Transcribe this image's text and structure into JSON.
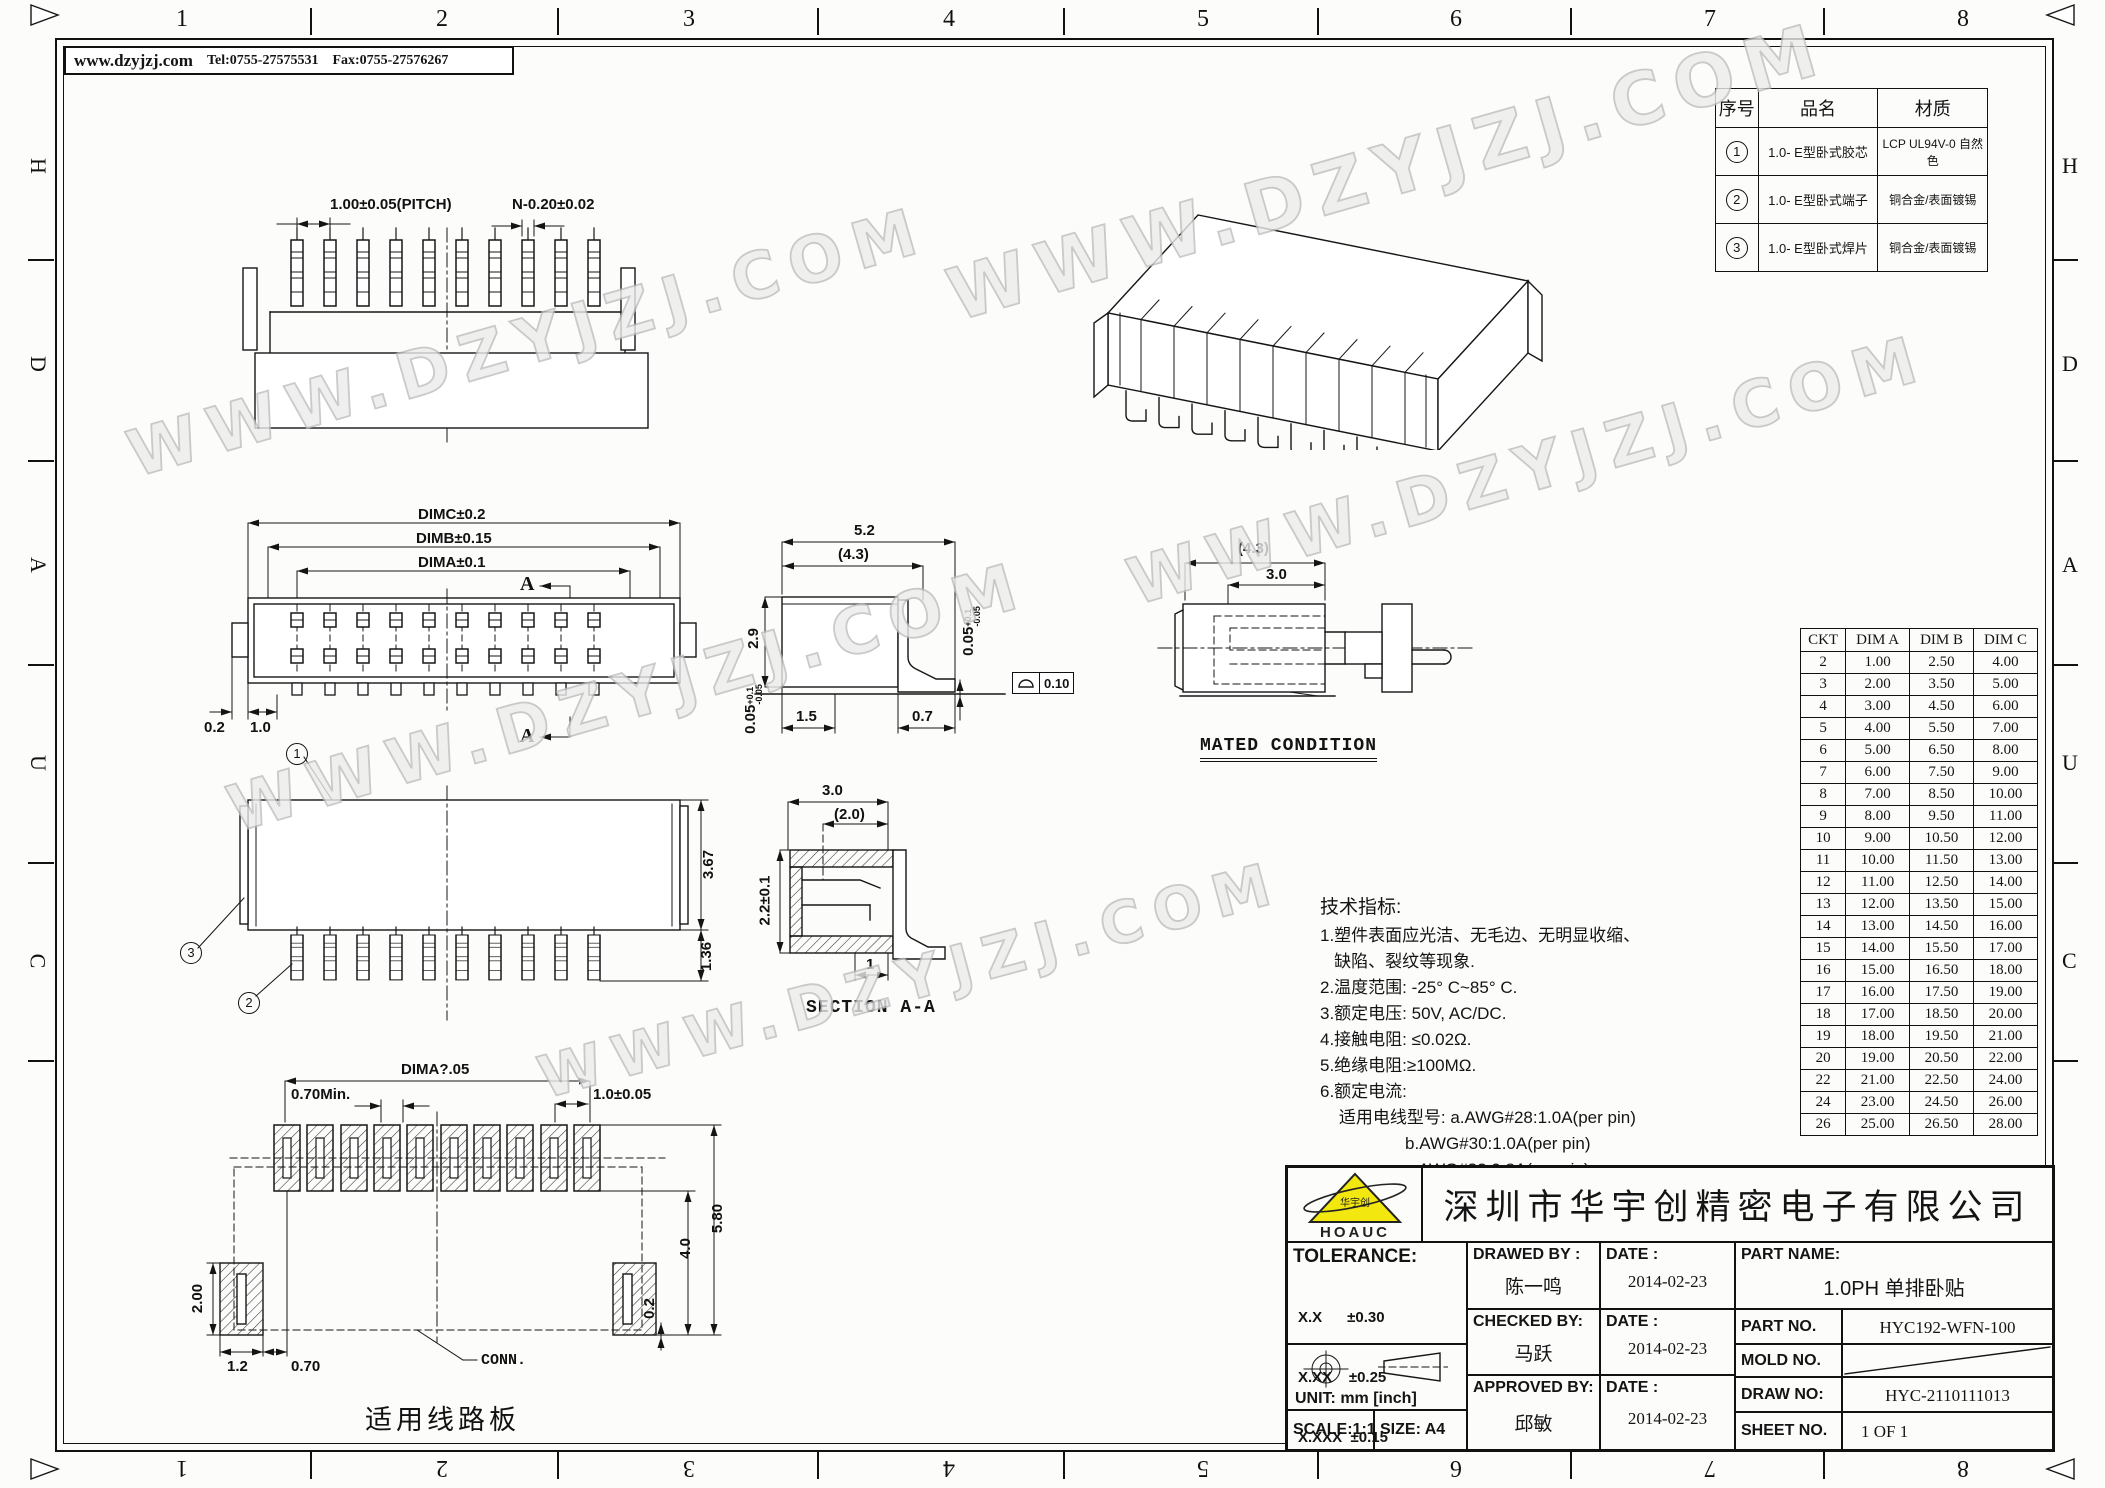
{
  "frame": {
    "website": "www.dzyjzj.com",
    "tel": "Tel:0755-27575531",
    "fax": "Fax:0755-27576267",
    "watermark_text": "WWW.DZYJZJ.COM",
    "zone_numbers": [
      "1",
      "2",
      "3",
      "4",
      "5",
      "6",
      "7",
      "8"
    ],
    "zone_letters": [
      "H",
      "D",
      "A",
      "U",
      "C"
    ]
  },
  "parts_table": {
    "headers": [
      "序号",
      "品名",
      "材质"
    ],
    "rows": [
      {
        "no": "1",
        "name": "1.0- E型卧式胶芯",
        "material": "LCP UL94V-0 自然色"
      },
      {
        "no": "2",
        "name": "1.0- E型卧式端子",
        "material": "铜合金/表面镀锡"
      },
      {
        "no": "3",
        "name": "1.0- E型卧式焊片",
        "material": "铜合金/表面镀锡"
      }
    ]
  },
  "dim_table": {
    "headers": [
      "CKT",
      "DIM A",
      "DIM B",
      "DIM C"
    ],
    "rows": [
      [
        "2",
        "1.00",
        "2.50",
        "4.00"
      ],
      [
        "3",
        "2.00",
        "3.50",
        "5.00"
      ],
      [
        "4",
        "3.00",
        "4.50",
        "6.00"
      ],
      [
        "5",
        "4.00",
        "5.50",
        "7.00"
      ],
      [
        "6",
        "5.00",
        "6.50",
        "8.00"
      ],
      [
        "7",
        "6.00",
        "7.50",
        "9.00"
      ],
      [
        "8",
        "7.00",
        "8.50",
        "10.00"
      ],
      [
        "9",
        "8.00",
        "9.50",
        "11.00"
      ],
      [
        "10",
        "9.00",
        "10.50",
        "12.00"
      ],
      [
        "11",
        "10.00",
        "11.50",
        "13.00"
      ],
      [
        "12",
        "11.00",
        "12.50",
        "14.00"
      ],
      [
        "13",
        "12.00",
        "13.50",
        "15.00"
      ],
      [
        "14",
        "13.00",
        "14.50",
        "16.00"
      ],
      [
        "15",
        "14.00",
        "15.50",
        "17.00"
      ],
      [
        "16",
        "15.00",
        "16.50",
        "18.00"
      ],
      [
        "17",
        "16.00",
        "17.50",
        "19.00"
      ],
      [
        "18",
        "17.00",
        "18.50",
        "20.00"
      ],
      [
        "19",
        "18.00",
        "19.50",
        "21.00"
      ],
      [
        "20",
        "19.00",
        "20.50",
        "22.00"
      ],
      [
        "22",
        "21.00",
        "22.50",
        "24.00"
      ],
      [
        "24",
        "23.00",
        "24.50",
        "26.00"
      ],
      [
        "26",
        "25.00",
        "26.50",
        "28.00"
      ]
    ]
  },
  "notes": {
    "title": "技术指标:",
    "lines": [
      "1.塑件表面应光洁、无毛边、无明显收缩、",
      "   缺陷、裂纹等现象.",
      "2.温度范围: -25° C~85° C.",
      "3.额定电压: 50V, AC/DC.",
      "4.接触电阻: ≤0.02Ω.",
      "5.绝缘电阻:≥100MΩ.",
      "6.额定电流:",
      "    适用电线型号: a.AWG#28:1.0A(per pin)",
      "                  b.AWG#30:1.0A(per pin)",
      "                  c.AWG#32:0.8A(per pin)"
    ]
  },
  "views": {
    "top": {
      "pitch": "1.00±0.05(PITCH)",
      "n": "N-0.20±0.02"
    },
    "front": {
      "dimc": "DIMC±0.2",
      "dimb": "DIMB±0.15",
      "dima": "DIMA±0.1",
      "a": "A",
      "d02": "0.2",
      "d10": "1.0",
      "b1": "1"
    },
    "side": {
      "d52": "5.2",
      "d43": "(4.3)",
      "d29": "2.9",
      "d005": "0.05",
      "d005_up": "+0.1",
      "d005_dn": "-0.05",
      "d15": "1.5",
      "d07": "0.7",
      "flatness": "0.10"
    },
    "mated": {
      "d43": "(4.3)",
      "d30": "3.0",
      "caption": "MATED CONDITION"
    },
    "bottom": {
      "d367": "3.67",
      "d136": "1.36",
      "b2": "2",
      "b3": "3"
    },
    "section": {
      "d30": "3.0",
      "d20": "(2.0)",
      "d22": "2.2±0.1",
      "d1": "1",
      "caption": "SECTION A-A"
    },
    "pcb": {
      "dima": "DIMA?.05",
      "d070min": "0.70Min.",
      "d10": "1.0±0.05",
      "d580": "5.80",
      "d40": "4.0",
      "d02": "0.2",
      "d200": "2.00",
      "d12": "1.2",
      "d070": "0.70",
      "conn": "CONN.",
      "caption": "适用线路板"
    }
  },
  "title_block": {
    "logo_text": "HOAUC",
    "logo_cn": "华宇创",
    "company": "深圳市华宇创精密电子有限公司",
    "tolerance_title": "TOLERANCE:",
    "tol1": "X.X      ±0.30",
    "tol2": "X.XX    ±0.25",
    "tol3": "X.XXX  ±0.15",
    "tol_angle": "X.°  ±2°        X.X°  ±0.5°",
    "unit": "UNIT:  mm  [inch]",
    "scale": "SCALE:1:1",
    "size": "SIZE:  A4",
    "drawed_label": "DRAWED BY :",
    "checked_label": "CHECKED BY:",
    "approved_label": "APPROVED BY:",
    "date_label": "DATE :",
    "drawed_by": "陈一鸣",
    "checked_by": "马跃",
    "approved_by": "邱敏",
    "date1": "2014-02-23",
    "date2": "2014-02-23",
    "date3": "2014-02-23",
    "part_name_label": "PART NAME:",
    "part_name": "1.0PH 单排卧贴",
    "part_no_label": "PART NO.",
    "part_no": "HYC192-WFN-100",
    "mold_no_label": "MOLD NO.",
    "draw_no_label": "DRAW NO:",
    "draw_no": "HYC-2110111013",
    "sheet_no_label": "SHEET NO.",
    "sheet_no": "1 OF 1"
  }
}
